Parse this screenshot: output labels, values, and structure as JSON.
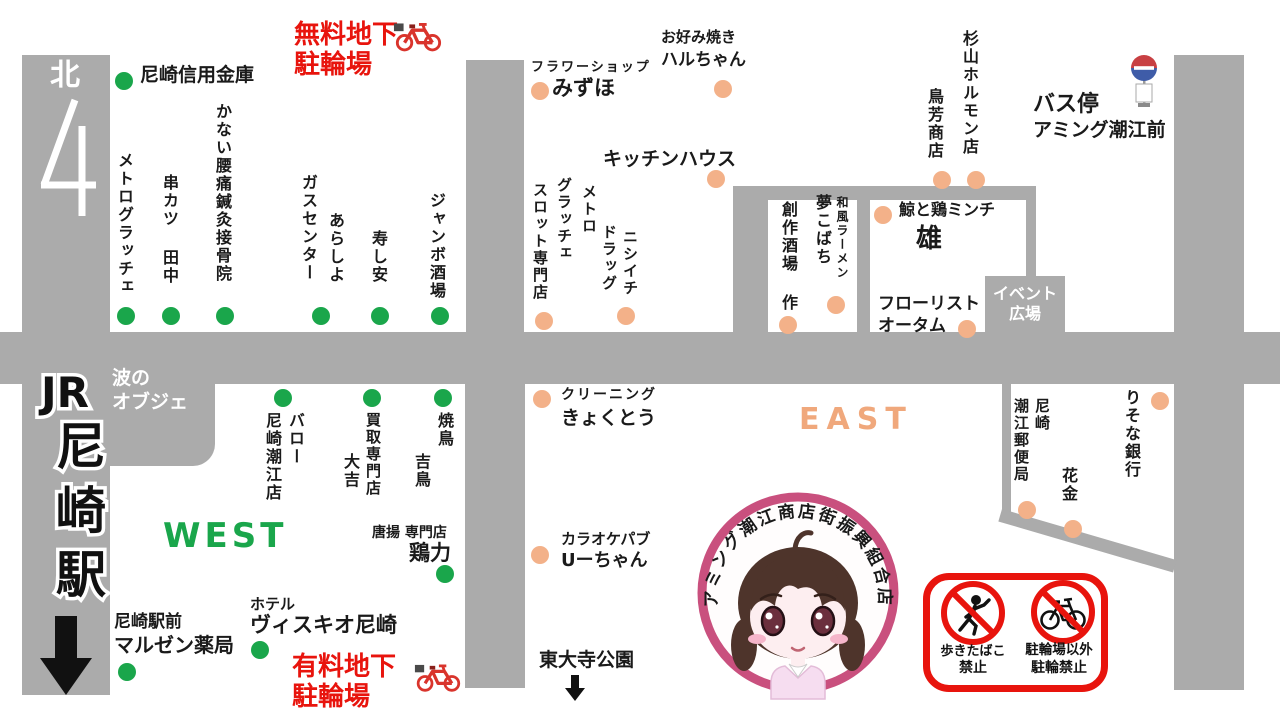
{
  "colors": {
    "road": "#ababab",
    "west_green": "#1aa64b",
    "east_orange": "#f3b189",
    "east_text": "#f0a87c",
    "red": "#e8140d",
    "logo_ring": "#c9507e"
  },
  "station": {
    "jr": "JR",
    "name": "尼崎駅",
    "north": "北",
    "exit_number": "4"
  },
  "areas": {
    "west": "WEST",
    "east": "EAST",
    "event1": "イベント",
    "event2": "広場",
    "wave1": "波の",
    "wave2": "オブジェ",
    "park": "東大寺公園"
  },
  "bus": {
    "line1": "バス停",
    "line2": "アミング潮江前"
  },
  "parking": {
    "free1": "無料地下",
    "free2": "駐輪場",
    "paid1": "有料地下",
    "paid2": "駐輪場"
  },
  "logo": {
    "text": "アミング潮江商店街振興組合店"
  },
  "signs": {
    "smoke1": "歩きたばこ",
    "smoke2": "禁止",
    "bike1": "駐輪場以外",
    "bike2": "駐輪禁止"
  },
  "shops": [
    {
      "name": "尼崎信用金庫",
      "side": "west",
      "labels": [
        {
          "t": "尼崎信用金庫",
          "x": 140,
          "y": 64,
          "s": 19,
          "o": "h"
        }
      ],
      "dots": [
        [
          124,
          81
        ]
      ]
    },
    {
      "name": "メトログラッチェ",
      "side": "west",
      "labels": [
        {
          "t": "メトログラッチェ",
          "x": 116,
          "y": 152,
          "s": 16,
          "o": "v"
        }
      ],
      "dots": [
        [
          126,
          316
        ]
      ]
    },
    {
      "name": "串カツ 田中",
      "side": "west",
      "labels": [
        {
          "t": "串カツ 田中",
          "x": 161,
          "y": 174,
          "s": 16,
          "o": "v"
        }
      ],
      "dots": [
        [
          171,
          316
        ]
      ]
    },
    {
      "name": "かない腰痛鍼灸接骨院",
      "side": "west",
      "labels": [
        {
          "t": "かない腰痛鍼灸接骨院",
          "x": 214,
          "y": 103,
          "s": 16,
          "o": "v"
        }
      ],
      "dots": [
        [
          225,
          316
        ]
      ]
    },
    {
      "name": "ガスセンター",
      "side": "west",
      "labels": [
        {
          "t": "ガスセンター",
          "x": 300,
          "y": 174,
          "s": 16,
          "o": "v"
        }
      ],
      "dots": []
    },
    {
      "name": "あらしよ",
      "side": "west",
      "labels": [
        {
          "t": "あらしよ",
          "x": 327,
          "y": 212,
          "s": 16,
          "o": "v"
        }
      ],
      "dots": [
        [
          321,
          316
        ]
      ]
    },
    {
      "name": "寿し安",
      "side": "west",
      "labels": [
        {
          "t": "寿し安",
          "x": 370,
          "y": 230,
          "s": 16,
          "o": "v"
        }
      ],
      "dots": [
        [
          380,
          316
        ]
      ]
    },
    {
      "name": "ジャンボ酒場",
      "side": "west",
      "labels": [
        {
          "t": "ジャンボ酒場",
          "x": 428,
          "y": 192,
          "s": 16,
          "o": "v"
        }
      ],
      "dots": [
        [
          440,
          316
        ]
      ]
    },
    {
      "name": "バロー尼崎潮江店",
      "side": "west",
      "labels": [
        {
          "t": "バロー",
          "x": 287,
          "y": 412,
          "s": 16,
          "o": "v"
        },
        {
          "t": "尼崎潮江店",
          "x": 264,
          "y": 412,
          "s": 16,
          "o": "v"
        }
      ],
      "dots": [
        [
          283,
          398
        ]
      ]
    },
    {
      "name": "買取専門店 大吉",
      "side": "west",
      "labels": [
        {
          "t": "買取専門店",
          "x": 365,
          "y": 412,
          "s": 15,
          "o": "v"
        },
        {
          "t": "大吉",
          "x": 342,
          "y": 453,
          "s": 16,
          "o": "v"
        }
      ],
      "dots": [
        [
          372,
          398
        ]
      ]
    },
    {
      "name": "焼鳥 吉鳥",
      "side": "west",
      "labels": [
        {
          "t": "焼鳥",
          "x": 436,
          "y": 412,
          "s": 16,
          "o": "v"
        },
        {
          "t": "吉鳥",
          "x": 413,
          "y": 453,
          "s": 16,
          "o": "v"
        }
      ],
      "dots": [
        [
          443,
          398
        ]
      ]
    },
    {
      "name": "唐揚専門店 鶏力",
      "side": "west",
      "labels": [
        {
          "t": "唐揚 専門店",
          "x": 372,
          "y": 525,
          "s": 14,
          "o": "h"
        },
        {
          "t": "鶏力",
          "x": 409,
          "y": 541,
          "s": 21,
          "o": "h"
        }
      ],
      "dots": [
        [
          445,
          574
        ]
      ]
    },
    {
      "name": "ホテル ヴィスキオ尼崎",
      "side": "west",
      "labels": [
        {
          "t": "ホテル",
          "x": 250,
          "y": 596,
          "s": 15,
          "o": "h"
        },
        {
          "t": "ヴィスキオ尼崎",
          "x": 250,
          "y": 613,
          "s": 21,
          "o": "h"
        }
      ],
      "dots": [
        [
          260,
          650
        ]
      ]
    },
    {
      "name": "尼崎駅前 マルゼン薬局",
      "side": "west",
      "labels": [
        {
          "t": "尼崎駅前",
          "x": 114,
          "y": 612,
          "s": 17,
          "o": "h"
        },
        {
          "t": "マルゼン薬局",
          "x": 114,
          "y": 634,
          "s": 20,
          "o": "h"
        }
      ],
      "dots": [
        [
          127,
          672
        ]
      ]
    },
    {
      "name": "フラワーショップ みずほ",
      "side": "east",
      "labels": [
        {
          "t": "フラワーショップ",
          "x": 531,
          "y": 60,
          "s": 13,
          "o": "h",
          "ls": 2
        },
        {
          "t": "みずほ",
          "x": 552,
          "y": 76,
          "s": 21,
          "o": "h"
        }
      ],
      "dots": [
        [
          540,
          91
        ]
      ]
    },
    {
      "name": "お好み焼き ハルちゃん",
      "side": "east",
      "labels": [
        {
          "t": "お好み焼き",
          "x": 661,
          "y": 29,
          "s": 15,
          "o": "h"
        },
        {
          "t": "ハルちゃん",
          "x": 661,
          "y": 50,
          "s": 17,
          "o": "h"
        }
      ],
      "dots": [
        [
          723,
          89
        ]
      ]
    },
    {
      "name": "キッチンハウス",
      "side": "east",
      "labels": [
        {
          "t": "キッチンハウス",
          "x": 603,
          "y": 148,
          "s": 19,
          "o": "h"
        }
      ],
      "dots": [
        [
          716,
          179
        ]
      ]
    },
    {
      "name": "メトロ グラッチェ スロット専門店",
      "side": "east",
      "labels": [
        {
          "t": "メトロ",
          "x": 581,
          "y": 184,
          "s": 15,
          "o": "v"
        },
        {
          "t": "グラッチェ",
          "x": 556,
          "y": 177,
          "s": 15,
          "o": "v"
        },
        {
          "t": "スロット専門店",
          "x": 532,
          "y": 182,
          "s": 15,
          "o": "v"
        }
      ],
      "dots": [
        [
          544,
          321
        ]
      ]
    },
    {
      "name": "ニシイチ ドラッグ",
      "side": "east",
      "labels": [
        {
          "t": "ニシイチ",
          "x": 622,
          "y": 229,
          "s": 15,
          "o": "v"
        },
        {
          "t": "ドラッグ",
          "x": 601,
          "y": 224,
          "s": 15,
          "o": "v"
        }
      ],
      "dots": [
        [
          626,
          316
        ]
      ]
    },
    {
      "name": "創作酒場 作",
      "side": "east",
      "labels": [
        {
          "t": "創作酒場 作",
          "x": 780,
          "y": 201,
          "s": 16,
          "o": "v"
        }
      ],
      "dots": [
        [
          788,
          325
        ]
      ]
    },
    {
      "name": "和風ラーメン 夢こばち",
      "side": "east",
      "labels": [
        {
          "t": "和風ラーメン",
          "x": 836,
          "y": 196,
          "s": 12,
          "o": "v"
        },
        {
          "t": "夢こばち",
          "x": 814,
          "y": 194,
          "s": 16,
          "o": "v"
        }
      ],
      "dots": [
        [
          836,
          305
        ]
      ]
    },
    {
      "name": "鳥芳商店",
      "side": "east",
      "labels": [
        {
          "t": "鳥芳商店",
          "x": 926,
          "y": 88,
          "s": 16,
          "o": "v"
        }
      ],
      "dots": [
        [
          942,
          180
        ]
      ]
    },
    {
      "name": "杉山ホルモン店",
      "side": "east",
      "labels": [
        {
          "t": "杉山ホルモン店",
          "x": 961,
          "y": 30,
          "s": 16,
          "o": "v"
        }
      ],
      "dots": [
        [
          976,
          180
        ]
      ]
    },
    {
      "name": "鯨と鶏ミンチ 雄",
      "side": "east",
      "labels": [
        {
          "t": "鯨と鶏ミンチ",
          "x": 899,
          "y": 201,
          "s": 16,
          "o": "h"
        },
        {
          "t": "雄",
          "x": 916,
          "y": 224,
          "s": 26,
          "o": "h"
        }
      ],
      "dots": [
        [
          883,
          215
        ]
      ]
    },
    {
      "name": "フローリスト オータム",
      "side": "east",
      "labels": [
        {
          "t": "フローリスト",
          "x": 878,
          "y": 294,
          "s": 17,
          "o": "h"
        },
        {
          "t": "オータム",
          "x": 878,
          "y": 316,
          "s": 17,
          "o": "h"
        }
      ],
      "dots": [
        [
          967,
          329
        ]
      ]
    },
    {
      "name": "クリーニング きょくとう",
      "side": "east",
      "labels": [
        {
          "t": "クリーニング",
          "x": 561,
          "y": 387,
          "s": 14,
          "o": "h",
          "ls": 2
        },
        {
          "t": "きょくとう",
          "x": 561,
          "y": 407,
          "s": 19,
          "o": "h"
        }
      ],
      "dots": [
        [
          542,
          399
        ]
      ]
    },
    {
      "name": "カラオケパブ Uーちゃん",
      "side": "east",
      "labels": [
        {
          "t": "カラオケパブ",
          "x": 561,
          "y": 531,
          "s": 15,
          "o": "h"
        },
        {
          "t": "Uーちゃん",
          "x": 561,
          "y": 550,
          "s": 18,
          "o": "h"
        }
      ],
      "dots": [
        [
          540,
          555
        ]
      ]
    },
    {
      "name": "尼崎潮江郵便局",
      "side": "east",
      "labels": [
        {
          "t": "尼崎",
          "x": 1034,
          "y": 398,
          "s": 15,
          "o": "v"
        },
        {
          "t": "潮江郵便局",
          "x": 1013,
          "y": 398,
          "s": 15,
          "o": "v"
        }
      ],
      "dots": [
        [
          1027,
          510
        ]
      ]
    },
    {
      "name": "花金",
      "side": "east",
      "labels": [
        {
          "t": "花金",
          "x": 1060,
          "y": 467,
          "s": 16,
          "o": "v"
        }
      ],
      "dots": [
        [
          1073,
          529
        ]
      ]
    },
    {
      "name": "りそな銀行",
      "side": "east",
      "labels": [
        {
          "t": "りそな銀行",
          "x": 1123,
          "y": 389,
          "s": 16,
          "o": "v"
        }
      ],
      "dots": [
        [
          1160,
          401
        ]
      ]
    }
  ]
}
